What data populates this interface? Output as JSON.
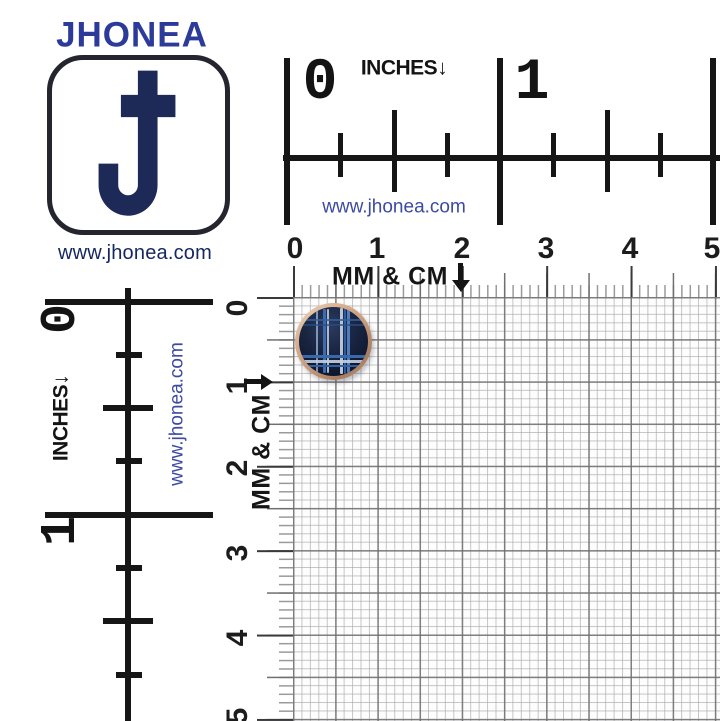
{
  "brand": {
    "name": "JHONEA",
    "website": "www.jhonea.com"
  },
  "rulers": {
    "inch_top": {
      "unit_label": "INCHES",
      "arrow": "↓",
      "numbers": [
        "0",
        "1"
      ],
      "website": "www.jhonea.com"
    },
    "mm_top": {
      "unit_label": "MM & CM",
      "numbers": [
        "0",
        "1",
        "2",
        "3",
        "4",
        "5"
      ]
    },
    "inch_left": {
      "unit_label": "INCHES",
      "arrow": "↓",
      "numbers": [
        "0",
        "1"
      ],
      "website": "www.jhonea.com"
    },
    "mm_left": {
      "unit_label": "MM & CM",
      "numbers": [
        "0",
        "1",
        "2",
        "3",
        "4",
        "5"
      ]
    }
  },
  "colors": {
    "brand_blue": "#2c3a9a",
    "logo_navy": "#1d2a57",
    "website_blue": "#3c4aa2",
    "ruler_black": "#161616",
    "grid_minor": "#a8a8aa",
    "grid_major": "#6e6e70",
    "button_rim_copper": "#c59a7a",
    "button_face_navy": "#141f38",
    "button_stripe_blue": "#3f6fb3",
    "button_stripe_silver": "#c6d2e2"
  }
}
